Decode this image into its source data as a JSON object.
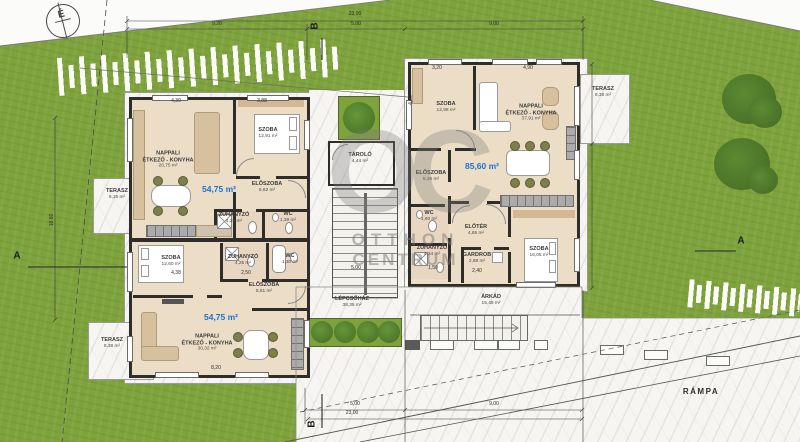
{
  "meta": {
    "compass_label": "É"
  },
  "watermark": {
    "monogram": "OC",
    "line1": "OTTHON",
    "line2": "CENTRUM"
  },
  "colors": {
    "area_text": "#1a73d4",
    "grass": "#7ea23c",
    "wall": "#2f2d2a",
    "blue_label": "#1a73d4"
  },
  "unit_areas": [
    {
      "text": "54,75 m²",
      "x": 219,
      "y": 189
    },
    {
      "text": "54,75 m²",
      "x": 221,
      "y": 317
    },
    {
      "text": "85,60 m²",
      "x": 482,
      "y": 166
    }
  ],
  "room_labels": [
    {
      "lines": [
        "NAPPALI",
        "ÉTKEZŐ - KONYHA"
      ],
      "area": "26,75 m²",
      "x": 168,
      "y": 160
    },
    {
      "lines": [
        "SZOBA"
      ],
      "area": "12,91 m²",
      "x": 268,
      "y": 133
    },
    {
      "lines": [
        "ELŐSZOBA"
      ],
      "area": "5,62 m²",
      "x": 267,
      "y": 187
    },
    {
      "lines": [
        "ZUHANYZÓ"
      ],
      "area": "4,25 m²",
      "x": 234,
      "y": 218
    },
    {
      "lines": [
        "WC"
      ],
      "area": "1,39 m²",
      "x": 288,
      "y": 217
    },
    {
      "lines": [
        "SZOBA"
      ],
      "area": "12,60 m²",
      "x": 171,
      "y": 261
    },
    {
      "lines": [
        "ZUHANYZÓ"
      ],
      "area": "4,25 m²",
      "x": 243,
      "y": 260
    },
    {
      "lines": [
        "WC"
      ],
      "area": "1,30 m²",
      "x": 290,
      "y": 259
    },
    {
      "lines": [
        "ELŐSZOBA"
      ],
      "area": "5,61 m²",
      "x": 264,
      "y": 288
    },
    {
      "lines": [
        "NAPPALI",
        "ÉTKEZŐ - KONYHA"
      ],
      "area": "30,32 m²",
      "x": 207,
      "y": 343
    },
    {
      "lines": [
        "SZOBA"
      ],
      "area": "12,98 m²",
      "x": 446,
      "y": 107
    },
    {
      "lines": [
        "NAPPALI",
        "ÉTKEZŐ - KONYHA"
      ],
      "area": "37,91 m²",
      "x": 531,
      "y": 113
    },
    {
      "lines": [
        "ELŐSZOBA"
      ],
      "area": "5,36 m²",
      "x": 431,
      "y": 176
    },
    {
      "lines": [
        "WC"
      ],
      "area": "1,60 m²",
      "x": 429,
      "y": 216
    },
    {
      "lines": [
        "ZUHANYZÓ"
      ],
      "area": "4,34 m²",
      "x": 432,
      "y": 251
    },
    {
      "lines": [
        "ELŐTÉR"
      ],
      "area": "4,65 m²",
      "x": 476,
      "y": 230
    },
    {
      "lines": [
        "GARDROB"
      ],
      "area": "2,88 m²",
      "x": 477,
      "y": 258
    },
    {
      "lines": [
        "SZOBA"
      ],
      "area": "16,05 m²",
      "x": 539,
      "y": 252
    },
    {
      "lines": [
        "TÁROLÓ"
      ],
      "area": "4,44 m²",
      "x": 360,
      "y": 158
    }
  ],
  "outdoor_labels": [
    {
      "lines": [
        "TERASZ"
      ],
      "area": "6,15 m²",
      "x": 117,
      "y": 194,
      "big": false
    },
    {
      "lines": [
        "TERASZ"
      ],
      "area": "8,38 m²",
      "x": 112,
      "y": 343,
      "big": false
    },
    {
      "lines": [
        "TERASZ"
      ],
      "area": "8,38 m²",
      "x": 603,
      "y": 92,
      "big": false
    },
    {
      "lines": [
        "LÉPCSŐHÁZ"
      ],
      "area": "38,35 m²",
      "x": 352,
      "y": 302,
      "big": false
    },
    {
      "lines": [
        "ÁRKÁD"
      ],
      "area": "15,45 m²",
      "x": 491,
      "y": 300,
      "big": false
    },
    {
      "lines": [
        "RÁMPA"
      ],
      "area": "",
      "x": 701,
      "y": 392,
      "big": true
    }
  ],
  "dimensions": [
    {
      "t": "23,00",
      "x": 355,
      "y": 14,
      "r": 0
    },
    {
      "t": "9,20",
      "x": 217,
      "y": 24,
      "r": 0
    },
    {
      "t": "5,00",
      "x": 356,
      "y": 24,
      "r": 0
    },
    {
      "t": "9,00",
      "x": 494,
      "y": 24,
      "r": 0
    },
    {
      "t": "5,00",
      "x": 355,
      "y": 404,
      "r": 0
    },
    {
      "t": "9,00",
      "x": 494,
      "y": 404,
      "r": 0
    },
    {
      "t": "23,00",
      "x": 352,
      "y": 413,
      "r": 0
    },
    {
      "t": "18,60",
      "x": 52,
      "y": 220,
      "r": -90
    },
    {
      "t": "5,00",
      "x": 356,
      "y": 268,
      "r": 0
    },
    {
      "t": "2,40",
      "x": 477,
      "y": 271,
      "r": 0
    },
    {
      "t": "4,30",
      "x": 176,
      "y": 101,
      "r": 0
    },
    {
      "t": "3,88",
      "x": 262,
      "y": 101,
      "r": 0
    },
    {
      "t": "3,20",
      "x": 437,
      "y": 68,
      "r": 0
    },
    {
      "t": "4,90",
      "x": 528,
      "y": 68,
      "r": 0
    },
    {
      "t": "4,38",
      "x": 176,
      "y": 273,
      "r": 0
    },
    {
      "t": "2,50",
      "x": 246,
      "y": 273,
      "r": 0
    },
    {
      "t": "8,20",
      "x": 216,
      "y": 368,
      "r": 0
    },
    {
      "t": "1,50",
      "x": 433,
      "y": 268,
      "r": 0
    },
    {
      "t": "4,00",
      "x": 411,
      "y": 100,
      "r": -90
    }
  ],
  "section_markers": [
    {
      "t": "A",
      "x": 17,
      "y": 256,
      "r": 0
    },
    {
      "t": "B",
      "x": 315,
      "y": 26,
      "r": -90
    },
    {
      "t": "A",
      "x": 741,
      "y": 241,
      "r": 0
    },
    {
      "t": "B",
      "x": 312,
      "y": 424,
      "r": -90
    }
  ]
}
